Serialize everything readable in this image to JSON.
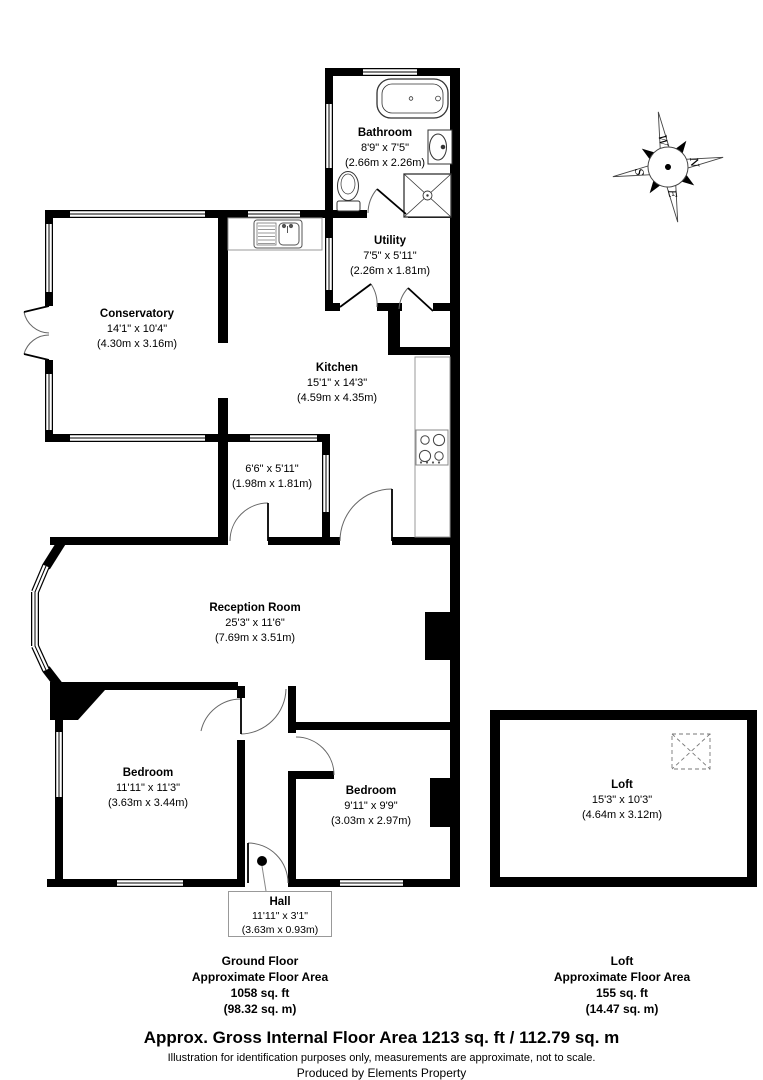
{
  "colors": {
    "wall": "#000000",
    "counter_outline": "#999999",
    "door_arc": "#666666",
    "label_box_border": "#999999"
  },
  "compass": {
    "n": "N",
    "e": "E",
    "s": "S",
    "w": "W"
  },
  "rooms": [
    {
      "id": "bathroom",
      "name": "Bathroom",
      "imperial": "8'9\" x 7'5\"",
      "metric": "(2.66m x 2.26m)"
    },
    {
      "id": "utility",
      "name": "Utility",
      "imperial": "7'5\" x 5'11\"",
      "metric": "(2.26m x 1.81m)"
    },
    {
      "id": "kitchen",
      "name": "Kitchen",
      "imperial": "15'1\" x 14'3\"",
      "metric": "(4.59m x 4.35m)"
    },
    {
      "id": "conservatory",
      "name": "Conservatory",
      "imperial": "14'1\" x 10'4\"",
      "metric": "(4.30m x 3.16m)"
    },
    {
      "id": "lobby",
      "name": "",
      "imperial": "6'6\" x 5'11\"",
      "metric": "(1.98m x 1.81m)"
    },
    {
      "id": "reception",
      "name": "Reception Room",
      "imperial": "25'3\" x 11'6\"",
      "metric": "(7.69m x 3.51m)"
    },
    {
      "id": "bedroom1",
      "name": "Bedroom",
      "imperial": "11'11\" x 11'3\"",
      "metric": "(3.63m x 3.44m)"
    },
    {
      "id": "bedroom2",
      "name": "Bedroom",
      "imperial": "9'11\" x 9'9\"",
      "metric": "(3.03m x 2.97m)"
    },
    {
      "id": "hall",
      "name": "Hall",
      "imperial": "11'11\" x 3'1\"",
      "metric": "(3.63m x 0.93m)"
    },
    {
      "id": "loft",
      "name": "Loft",
      "imperial": "15'3\" x 10'3\"",
      "metric": "(4.64m x 3.12m)"
    }
  ],
  "areas": {
    "ground": {
      "title": "Ground Floor",
      "subtitle": "Approximate Floor Area",
      "sqft": "1058 sq. ft",
      "sqm": "(98.32 sq. m)"
    },
    "loft": {
      "title": "Loft",
      "subtitle": "Approximate Floor Area",
      "sqft": "155 sq. ft",
      "sqm": "(14.47 sq. m)"
    }
  },
  "footer": {
    "title": "Approx. Gross Internal Floor Area 1213 sq. ft / 112.79 sq. m",
    "disclaimer": "Illustration for identification purposes only, measurements are approximate, not to scale.",
    "credit": "Produced by Elements Property"
  }
}
